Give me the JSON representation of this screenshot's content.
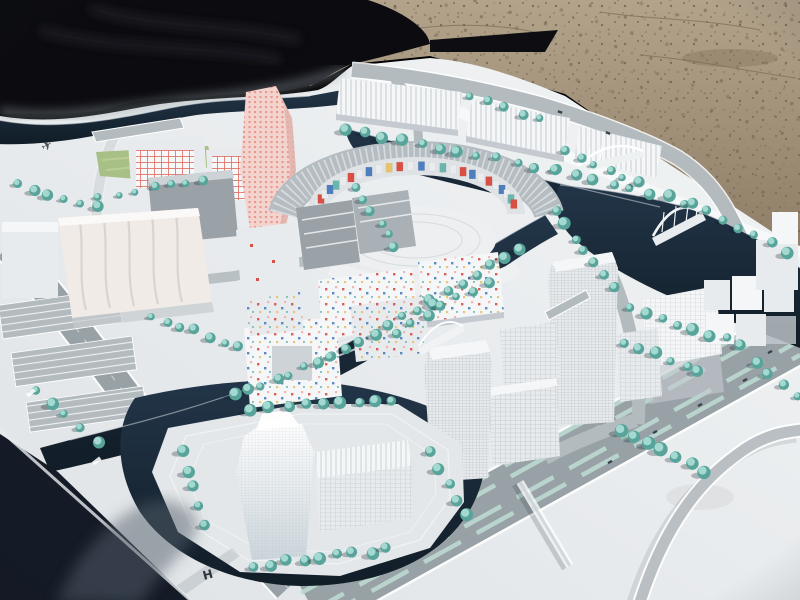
{
  "meta": {
    "title": "Architectural scale model of a waterfront urban district, photographed outdoors on gravel ground, partly covered by a black cloth"
  },
  "palette": {
    "sand_light": "#b3a38b",
    "sand_dark": "#8d7d66",
    "sand_dot1": "#6e604c",
    "sand_dot2": "#7d6e59",
    "sand_dot3": "#978770",
    "tarp": "#0c0c10",
    "tarp_ridge": "#26262e",
    "board_light": "#f2f4f5",
    "board_dark": "#dfe3e6",
    "board_edge": "#f6f8f9",
    "under_table": "#141a26",
    "water_top": "#223548",
    "water_bottom": "#111d27",
    "quay": "#cfd6da",
    "road": "#98a1a6",
    "road_light": "#b4bbbf",
    "median": "#bcd8d2",
    "tree_dark": "#58a39a",
    "tree_light": "#a8dcd3",
    "tree_shadow": "#0e1c24",
    "grass": "#a8bf85",
    "grass_light": "#bccf9a",
    "bldg_roof": "#f4f6f7",
    "bldg_face": "#e8ebed",
    "bldg_shade": "#c4cacf",
    "bldg_gray": "#9aa2a8",
    "bldg_gray_dark": "#868e94",
    "win_line": "#9fa8ae",
    "outline": "#7b858c",
    "cream": "#f0ebe7",
    "cream_line": "#d9d2cd",
    "pink_tower": "#f3d3cd",
    "red": "#d94f43",
    "blue": "#4d7fbe",
    "teal_tile": "#6ab5ad",
    "yellow": "#e5c36c",
    "pink_tile": "#efb3ac",
    "white_tile": "#e9ebec",
    "car": "#3a424a",
    "glyph": "#2e343b",
    "ring_roof": "#b6bdc2",
    "plaza": "#edeff0",
    "island": "#e3e7e9",
    "shadow_soft": "#55606c"
  },
  "glyphs": {
    "airplane": "✈",
    "metro": "H"
  },
  "scene": {
    "tree_rows": [
      [
        345,
        130,
        555,
        170,
        12,
        5
      ],
      [
        558,
        172,
        685,
        202,
        8,
        5
      ],
      [
        20,
        186,
        95,
        206,
        6,
        4.5
      ],
      [
        470,
        96,
        540,
        118,
        5,
        4
      ],
      [
        100,
        196,
        205,
        180,
        7,
        4
      ],
      [
        357,
        186,
        396,
        246,
        6,
        4.5
      ],
      [
        558,
        212,
        612,
        288,
        7,
        5
      ],
      [
        692,
        203,
        788,
        252,
        7,
        5
      ],
      [
        628,
        308,
        742,
        345,
        8,
        5
      ],
      [
        518,
        247,
        432,
        302,
        7,
        5
      ],
      [
        432,
        302,
        332,
        357,
        8,
        5
      ],
      [
        332,
        357,
        235,
        396,
        8,
        5
      ],
      [
        488,
        282,
        398,
        332,
        7,
        4.5
      ],
      [
        252,
        408,
        392,
        399,
        9,
        5
      ],
      [
        428,
        452,
        468,
        514,
        5,
        5.5
      ],
      [
        252,
        566,
        388,
        550,
        9,
        5.5
      ],
      [
        182,
        452,
        206,
        524,
        5,
        5
      ],
      [
        36,
        390,
        96,
        442,
        5,
        5
      ],
      [
        152,
        316,
        240,
        346,
        7,
        4.5
      ],
      [
        626,
        342,
        700,
        372,
        6,
        5
      ],
      [
        620,
        432,
        706,
        470,
        7,
        5.5
      ],
      [
        566,
        152,
        638,
        184,
        6,
        4.5
      ],
      [
        756,
        362,
        798,
        396,
        4,
        5
      ]
    ],
    "mosaic_sequence": [
      "w",
      "r",
      "w",
      "b",
      "t",
      "w",
      "r",
      "w",
      "b",
      "w",
      "y",
      "r",
      "w",
      "b",
      "w",
      "t",
      "w",
      "r",
      "b",
      "w",
      "r",
      "w",
      "b",
      "w",
      "t",
      "r"
    ],
    "cars": [
      [
        655,
        432,
        -29
      ],
      [
        700,
        405,
        -29
      ],
      [
        745,
        380,
        -29
      ],
      [
        610,
        462,
        -29
      ],
      [
        770,
        352,
        -29
      ],
      [
        560,
        112,
        20
      ],
      [
        608,
        133,
        22
      ]
    ],
    "road_labels": [
      [
        26,
        394
      ],
      [
        92,
        462
      ]
    ]
  }
}
